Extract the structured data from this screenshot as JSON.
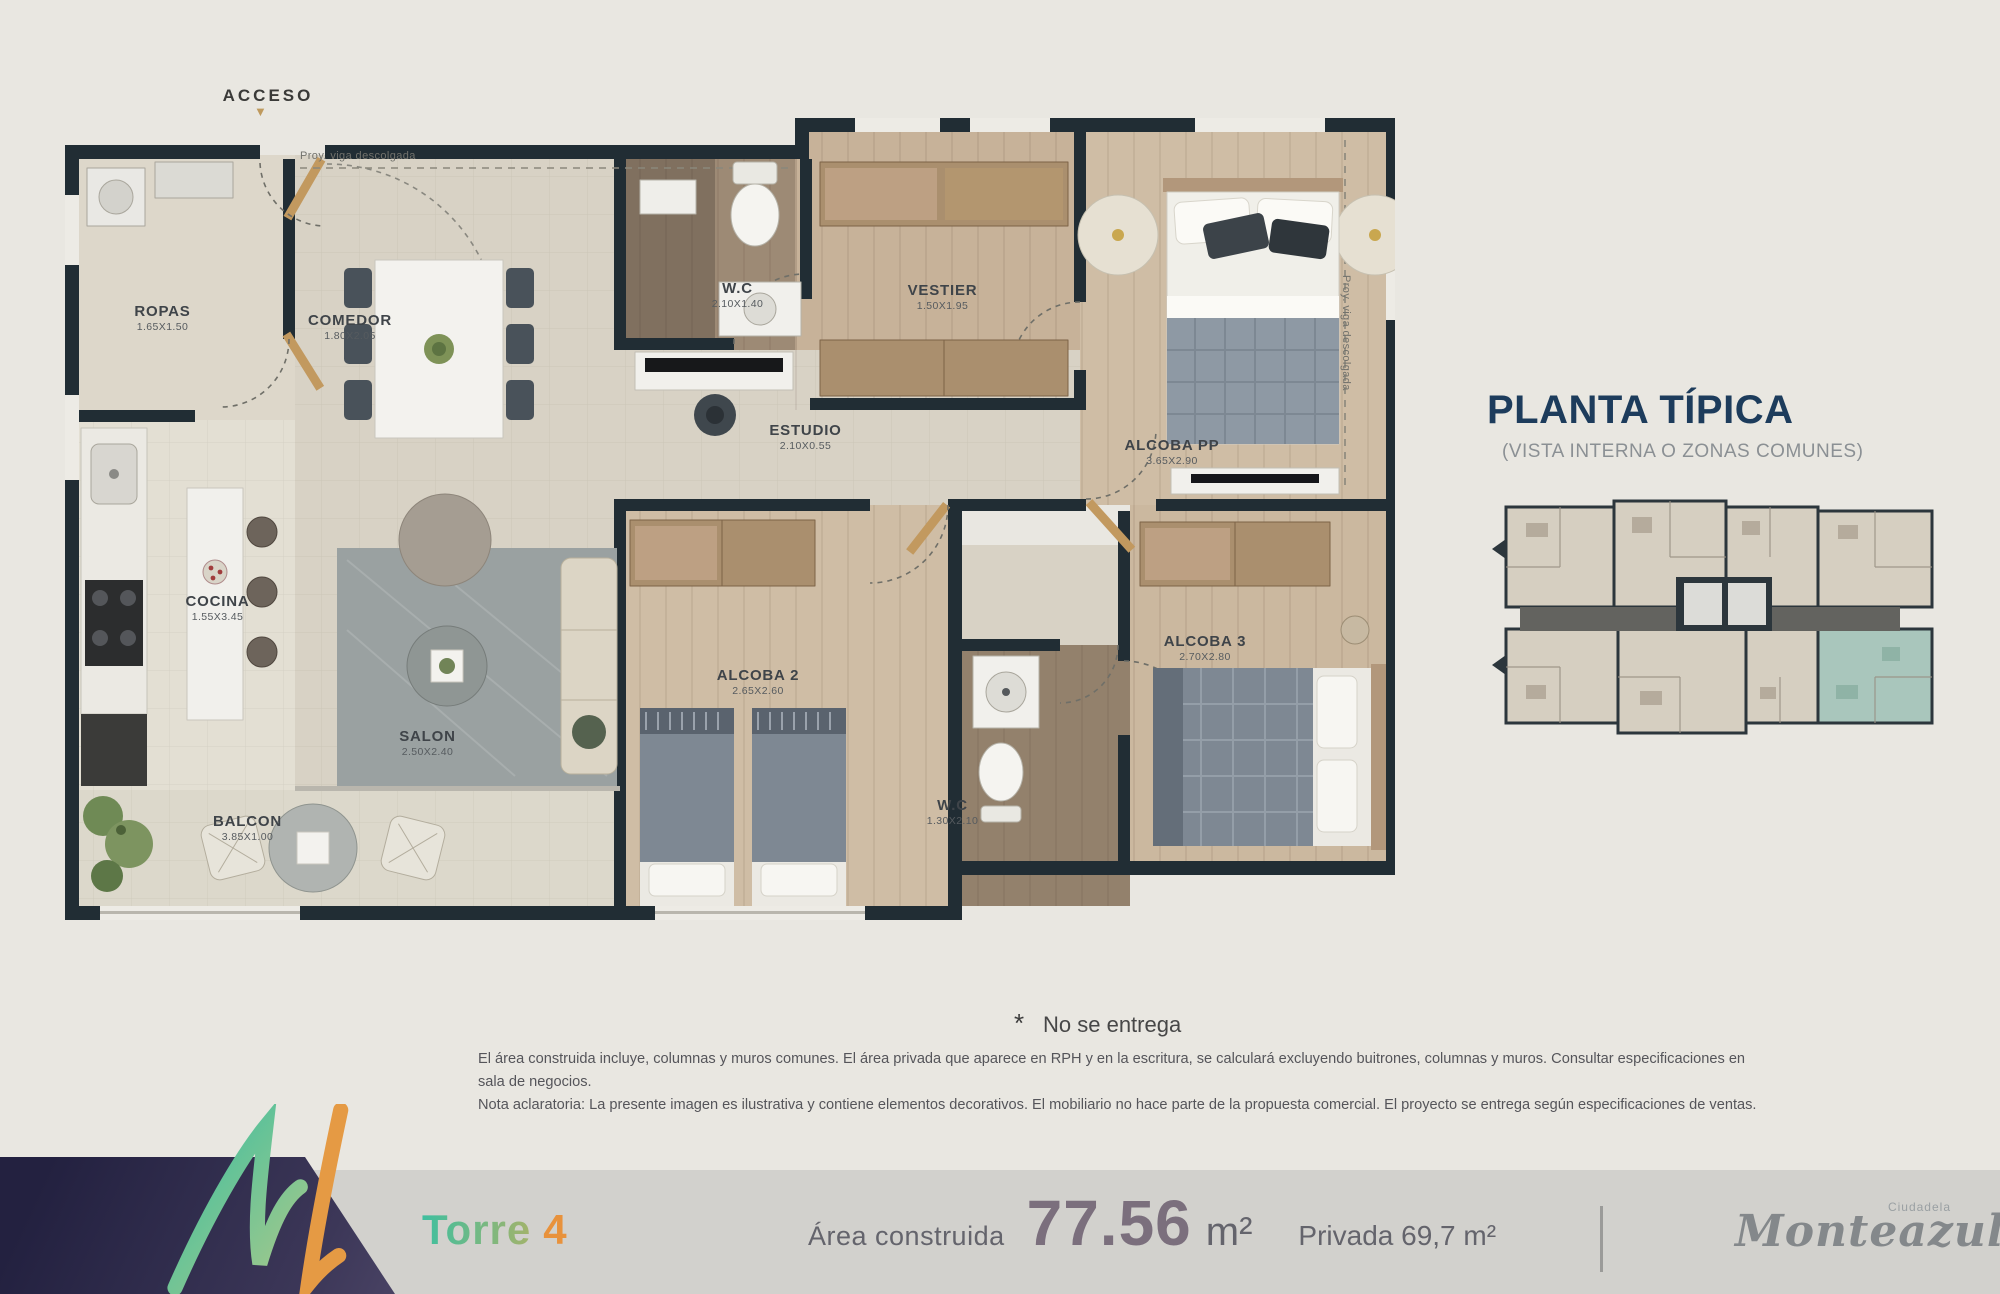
{
  "plan": {
    "access_label": "ACCESO",
    "access_arrow": "▼",
    "beam_note_top": "Proy. viga descolgada",
    "beam_note_right": "Proy. viga descolgada",
    "rooms": [
      {
        "label": "ROPAS",
        "dims": "1.65X1.50"
      },
      {
        "label": "COMEDOR",
        "dims": "1.80X2.05"
      },
      {
        "label": "W.C",
        "dims": "2.10X1.40"
      },
      {
        "label": "VESTIER",
        "dims": "1.50X1.95"
      },
      {
        "label": "ALCOBA PP",
        "dims": "3.65X2.90"
      },
      {
        "label": "ESTUDIO",
        "dims": "2.10X0.55"
      },
      {
        "label": "COCINA",
        "dims": "1.55X3.45"
      },
      {
        "label": "SALON",
        "dims": "2.50X2.40"
      },
      {
        "label": "ALCOBA 2",
        "dims": "2.65X2.60"
      },
      {
        "label": "ALCOBA 3",
        "dims": "2.70X2.80"
      },
      {
        "label": "W.C",
        "dims": "1.30X2.10"
      },
      {
        "label": "BALCON",
        "dims": "3.85X1.00"
      }
    ]
  },
  "side_panel": {
    "title": "PLANTA TÍPICA",
    "subtitle": "(VISTA INTERNA O ZONAS COMUNES)"
  },
  "notes": {
    "asterisk": "*",
    "no_delivery": "No se entrega",
    "disclaimer_1": "El área construida incluye, columnas y muros comunes. El área privada que aparece en RPH y en la escritura, se calculará excluyendo buitrones, columnas y muros. Consultar especificaciones en sala de negocios.",
    "disclaimer_2": "Nota aclaratoria: La presente imagen es ilustrativa y contiene elementos decorativos. El mobiliario no hace parte de la propuesta comercial. El proyecto se entrega según especificaciones de ventas."
  },
  "footer": {
    "tower_label": "Torre",
    "tower_number": "4",
    "area_label": "Área construida",
    "area_value": "77.56",
    "area_unit": "m²",
    "private_area": "Privada 69,7 m²",
    "brand_prefix": "Ciudadela",
    "brand_name": "Monteazul"
  },
  "colors": {
    "accent_teal": "#3fbf9f",
    "accent_orange": "#e8923c",
    "navy_title": "#1d3c5c",
    "wall": "#212d34",
    "unit_highlight": "#a9c6bc"
  }
}
